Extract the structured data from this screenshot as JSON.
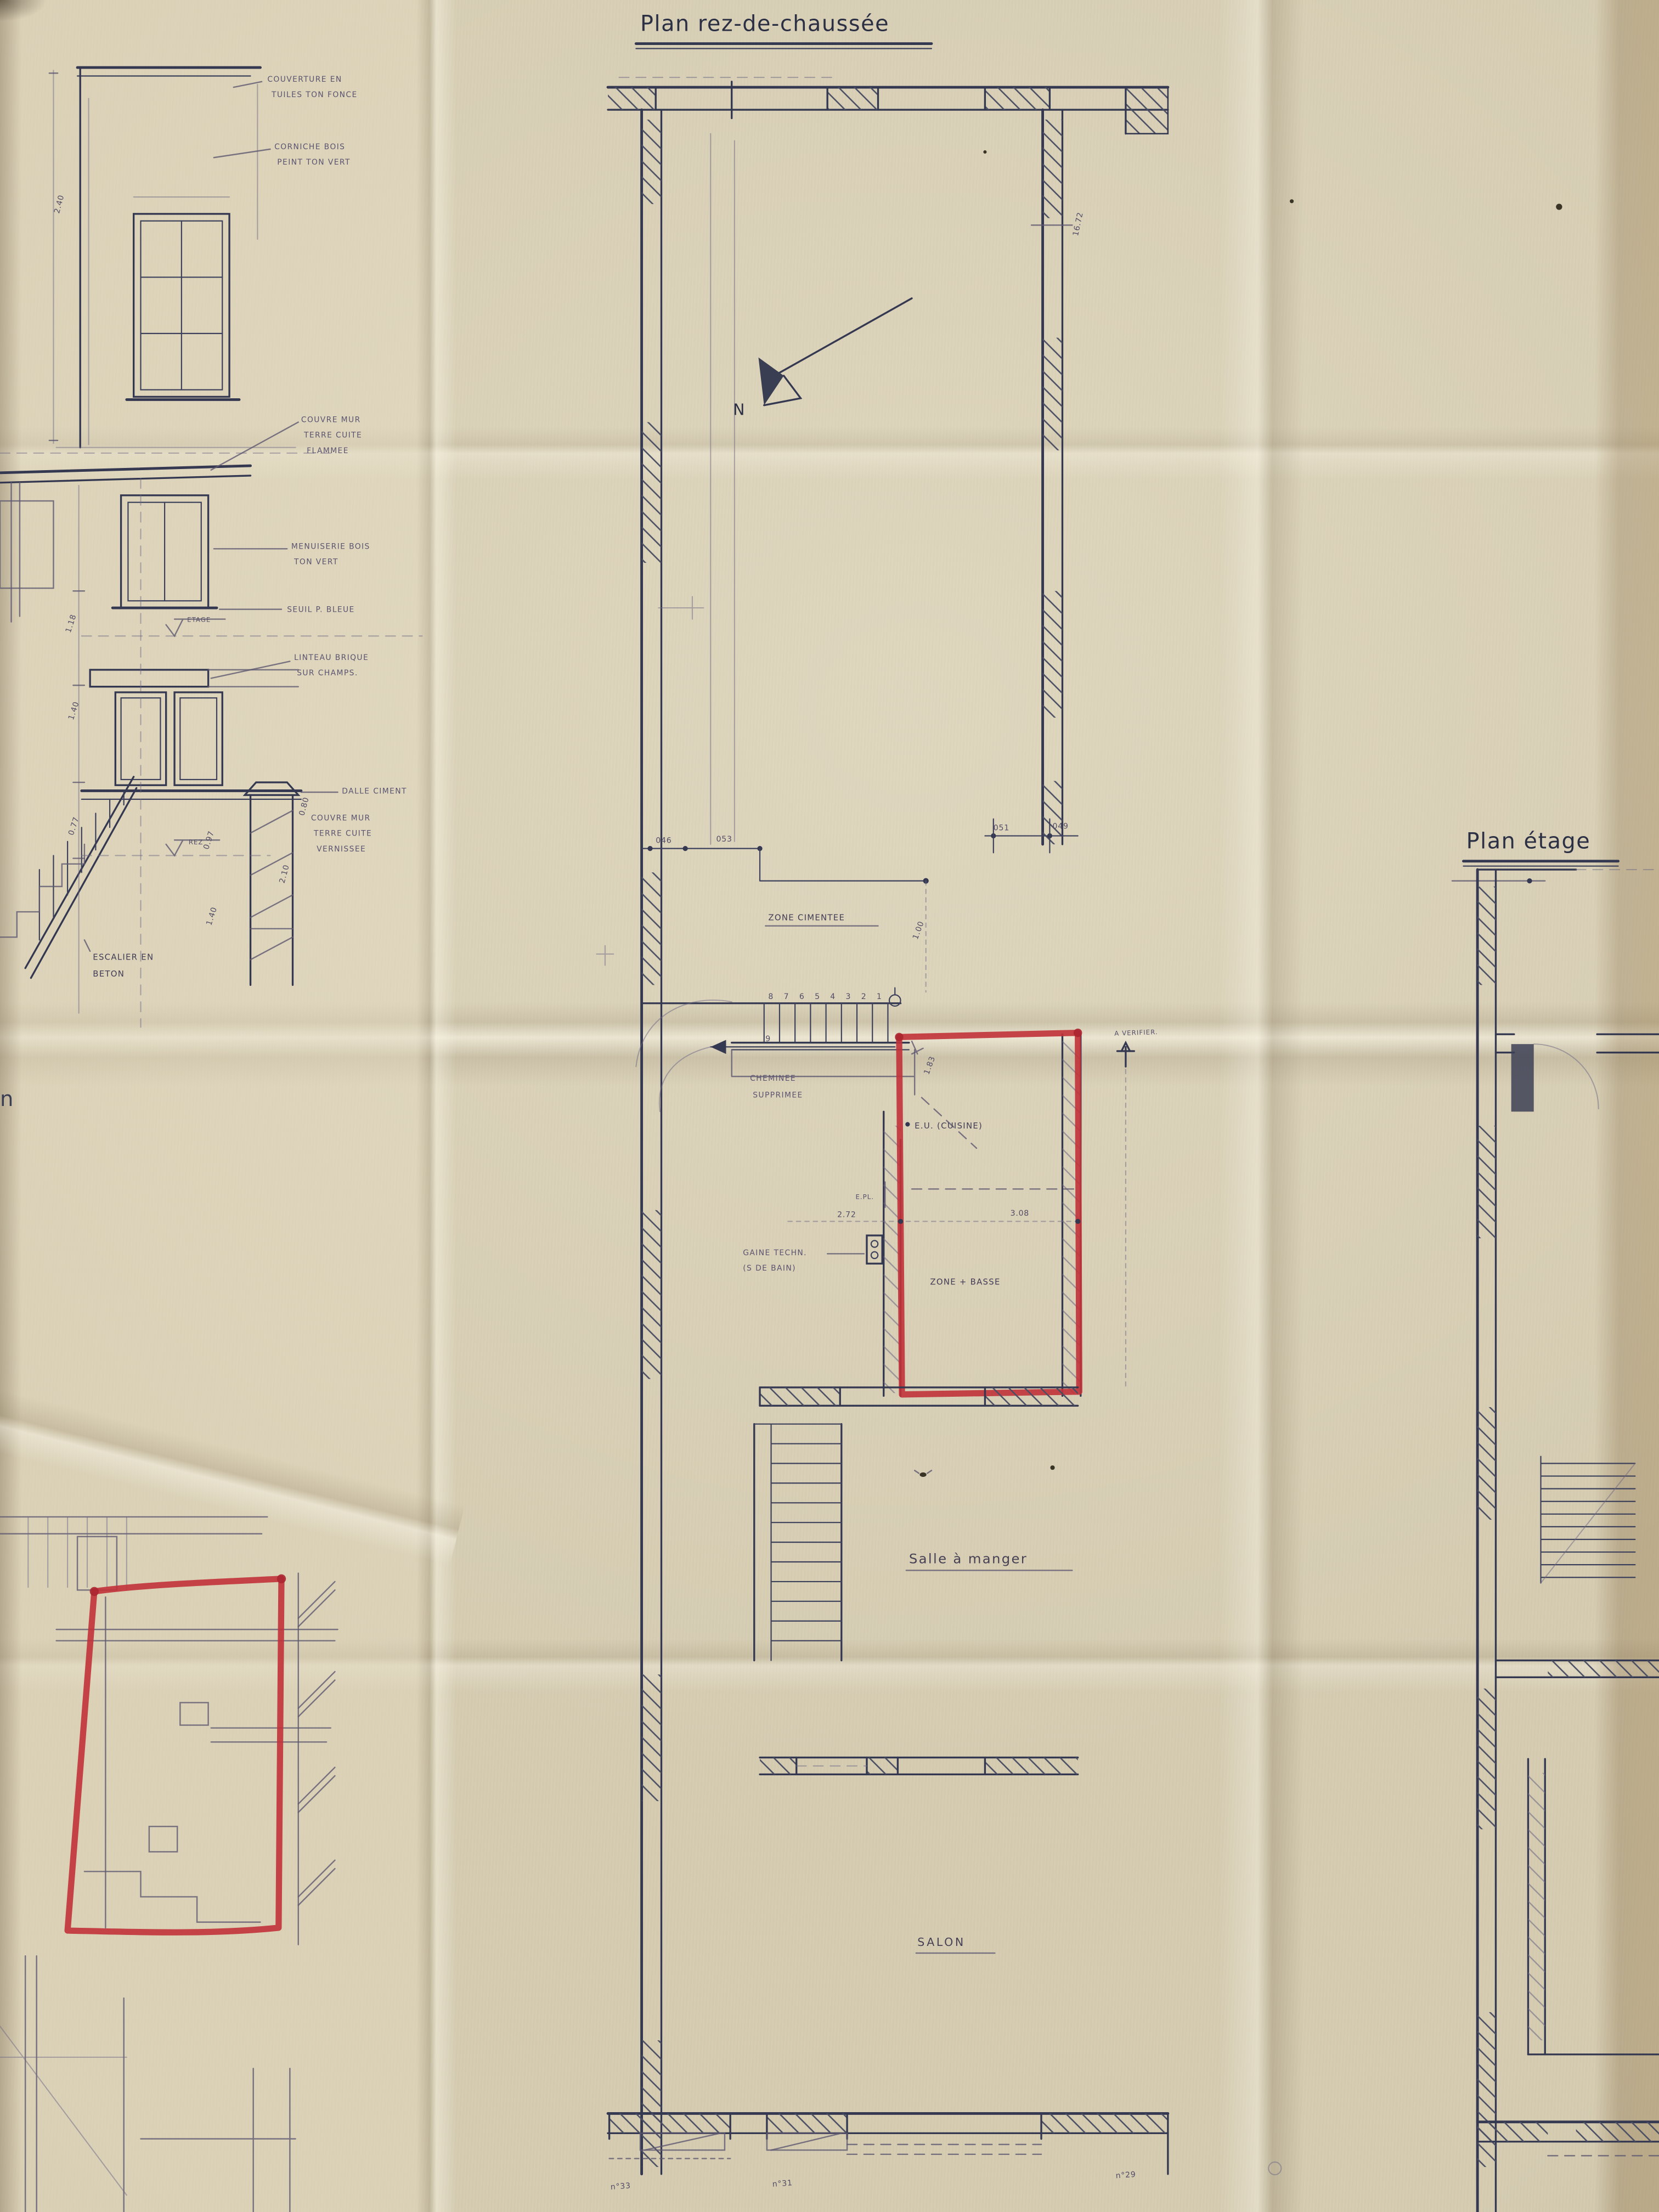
{
  "colors": {
    "paper": "#d5ccb2",
    "ink": "#343850",
    "pencil": "#5f5971",
    "marker_red": "#c13239"
  },
  "titles": {
    "ground_floor": "Plan rez-de-chaussée",
    "upper_floor": "Plan étage"
  },
  "north_label": "N",
  "elevations": {
    "couverture_1": "COUVERTURE EN",
    "couverture_2": "TUILES TON FONCE",
    "corniche_1": "CORNICHE BOIS",
    "corniche_2": "PEINT TON VERT",
    "couvre_mur_1": "COUVRE MUR",
    "couvre_mur_2": "TERRE CUITE",
    "couvre_mur_3": "FLAMMEE",
    "menuiserie_1": "MENUISERIE BOIS",
    "menuiserie_2": "TON VERT",
    "seuil": "SEUIL P. BLEUE",
    "linteau_1": "LINTEAU BRIQUE",
    "linteau_2": "SUR CHAMPS.",
    "dalle": "DALLE CIMENT",
    "couvre_mur_v_1": "COUVRE MUR",
    "couvre_mur_v_2": "TERRE CUITE",
    "couvre_mur_v_3": "VERNISSEE",
    "escalier_1": "ESCALIER EN",
    "escalier_2": "BETON",
    "level_etage": "ETAGE",
    "level_rez": "REZ",
    "dim_240": "2.40",
    "dim_118": "1.18",
    "dim_140a": "1.40",
    "dim_077": "0.77",
    "dim_097": "0.97",
    "dim_140b": "1.40",
    "dim_210": "2.10",
    "dim_080": "0.80",
    "fragment": "n"
  },
  "plan": {
    "zone_cimentee": "ZONE CIMENTEE",
    "cheminee_1": "CHEMINEE",
    "cheminee_2": "SUPPRIMEE",
    "eu_cuisine": "E.U. (CUISINE)",
    "epl": "E.PL.",
    "gaine_1": "GAINE TECHN.",
    "gaine_2": "(S DE BAIN)",
    "zone_basse": "ZONE + BASSE",
    "salle_a_manger": "Salle à manger",
    "salon": "SALON",
    "a_verifier": "A VERIFIER.",
    "dims": {
      "depth": "16.72",
      "d1": "046",
      "d2": "053",
      "d3": "051",
      "d4": "049",
      "d5": "1.00",
      "d6": "1.83",
      "d7": "2.72",
      "d8": "3.08"
    },
    "stair_treads": [
      "8",
      "7",
      "6",
      "5",
      "4",
      "3",
      "2",
      "1"
    ],
    "stair_landing": "9",
    "house_numbers": [
      "n°33",
      "n°31",
      "n°29"
    ]
  }
}
